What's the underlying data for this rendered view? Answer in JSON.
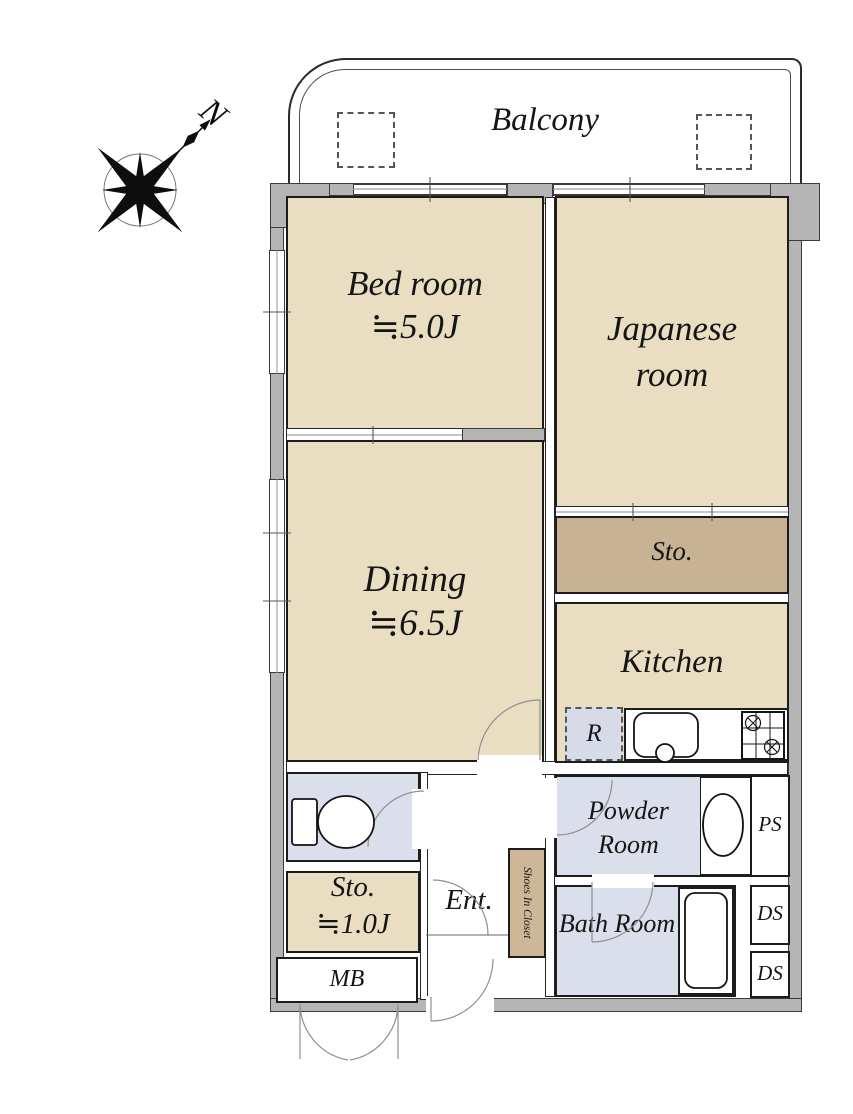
{
  "colors": {
    "room_floor": "#e9dec2",
    "storage_floor": "#c8b294",
    "closet_floor": "#cdb797",
    "wet_room_floor": "#dbdfeb",
    "wall_gray": "#b5b5b5",
    "line_black": "#1c1c1c"
  },
  "compass": {
    "north_label": "N"
  },
  "balcony": {
    "label": "Balcony"
  },
  "rooms": {
    "bedroom": {
      "name": "Bed room",
      "size": "≒5.0J"
    },
    "japanese_room": {
      "name": "Japanese room"
    },
    "dining": {
      "name": "Dining",
      "size": "≒6.5J"
    },
    "storage": {
      "label": "Sto."
    },
    "kitchen": {
      "label": "Kitchen"
    },
    "powder_room": {
      "label": "Powder Room"
    },
    "bath_room": {
      "label": "Bath Room"
    },
    "storage_small": {
      "name": "Sto.",
      "size": "≒1.0J"
    },
    "entrance": {
      "label": "Ent."
    }
  },
  "fixtures": {
    "refrigerator": {
      "label": "R"
    },
    "pipe_space": {
      "label": "PS"
    },
    "duct_space_1": {
      "label": "DS"
    },
    "duct_space_2": {
      "label": "DS"
    },
    "meter_box": {
      "label": "MB"
    },
    "shoes_closet": {
      "label": "Shoes In Closet"
    }
  }
}
